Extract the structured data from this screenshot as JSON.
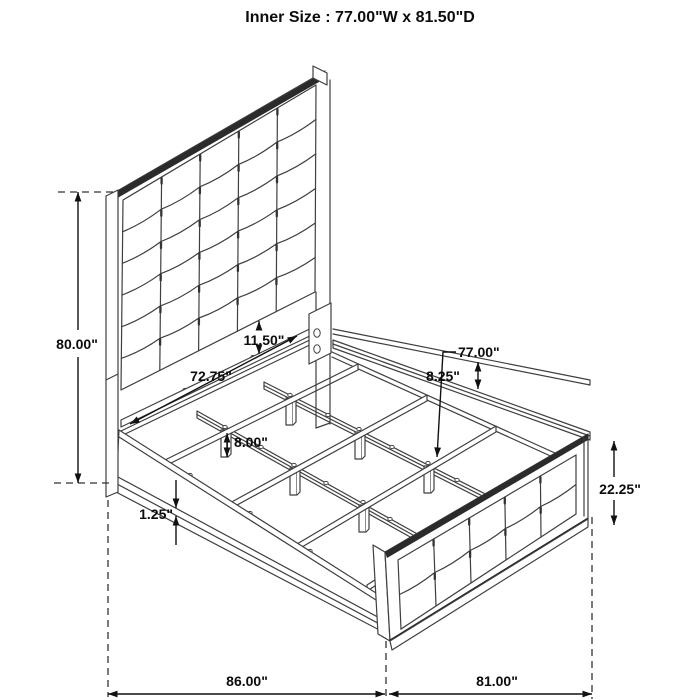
{
  "title": "Inner Size : 77.00\"W x 81.50\"D",
  "dimensions": {
    "headboard_height": "80.00\"",
    "headboard_panel_gap": "11.50\"",
    "head_rail_width": "72.75\"",
    "rail_to_slat_drop": "8.25\"",
    "slat_length": "77.00\"",
    "slat_leg_height": "8.00\"",
    "side_rail_lip": "1.25\"",
    "footboard_height": "22.25\"",
    "overall_depth": "86.00\"",
    "overall_width": "81.00\""
  }
}
